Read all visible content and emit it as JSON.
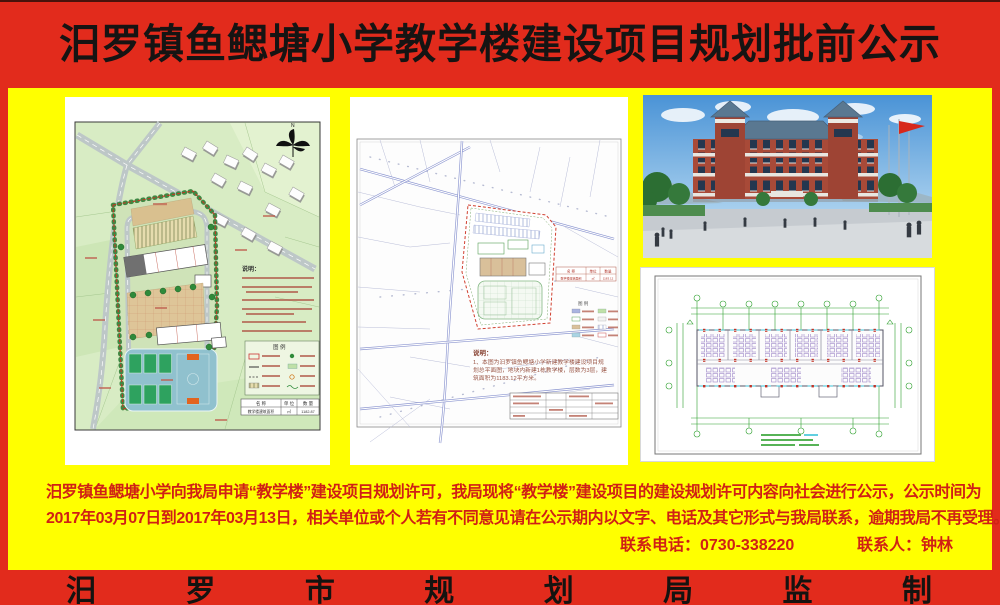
{
  "poster": {
    "colors": {
      "frame_red": "#e22b1c",
      "background_yellow": "#ffff00",
      "notice_text_red": "#d02015",
      "title_ink": "#161413",
      "brick_red": "#a84a38",
      "roof_blue_gray": "#5a7891",
      "court_green": "#2ea25f",
      "cad_green": "#2da02d"
    },
    "header": {
      "title": "汨罗镇鱼鳃塘小学教学楼建设项目规划批前公示"
    },
    "notice": {
      "line1": "汨罗镇鱼鳃塘小学向我局申请“教学楼”建设项目规划许可，我局现将“教学楼”建设项目的建设规划许可内容向社会进行公示，公示时间为",
      "line2": "2017年03月07日到2017年03月13日，相关单位或个人若有不同意见请在公示期内以文字、电话及其它形式与我局联系，逾期我局不再受理。",
      "contact_phone": "联系电话：0730-338220",
      "contact_person": "联系人：钟林"
    },
    "footer": {
      "text": "汨罗市规划局监制"
    }
  },
  "panels": {
    "site_plan": {
      "notes_title": "说明：",
      "legend_title": "图 例",
      "north_label": "N",
      "table": {
        "col1": "名 称",
        "col2": "单 位",
        "col3": "数 量",
        "row1c1": "教学楼建筑面积",
        "row1c2": "㎡",
        "row1c3": "1182.87"
      }
    },
    "planning_map": {
      "notes_title": "说明：",
      "notes_line1": "1、本图为汨罗镇鱼鳃塘小学新建教学楼建设项目规",
      "notes_line2": "划总平面图，地块内新建1栋教学楼，层数为3层，建",
      "notes_line3": "筑面积为1183.12平方米。",
      "legend_title": "图 例",
      "table": {
        "col1": "名 称",
        "col2": "单位",
        "col3": "数量",
        "row1c1": "教学楼建筑面积",
        "row1c2": "㎡",
        "row1c3": "1183.12"
      }
    }
  }
}
